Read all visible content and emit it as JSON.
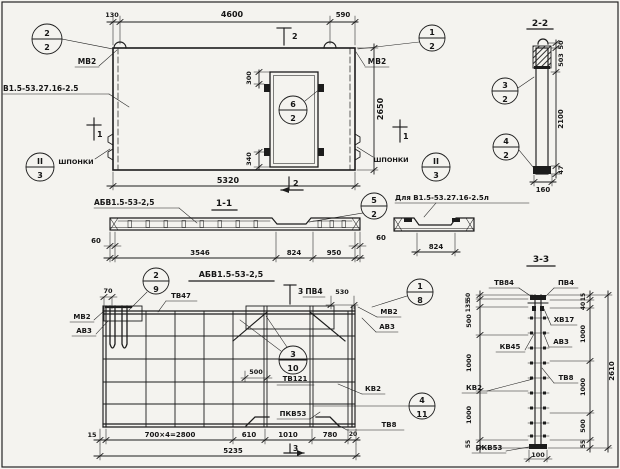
{
  "meta": {
    "paper_color": "#f4f3ef",
    "ink_color": "#1c1c1c",
    "drawing_type": "precast wall panel working drawing"
  },
  "plan": {
    "series_label": "В1.5-53.27.16-2.5",
    "mark_top_left": "МВ2",
    "mark_top_right": "МВ2",
    "keys_left": "ШПОНКИ",
    "keys_right": "ШПОНКИ",
    "dims": {
      "d130": "130",
      "d4600": "4600",
      "d590": "590",
      "d2650": "2650",
      "d5320": "5320",
      "d300": "300",
      "d340": "340"
    },
    "sections": {
      "s1": "1",
      "s2": "2"
    },
    "callouts": {
      "c22": {
        "num": "2",
        "den": "2"
      },
      "c12": {
        "num": "1",
        "den": "2"
      },
      "c62": {
        "num": "6",
        "den": "2"
      },
      "cII3_left": {
        "num": "II",
        "den": "3"
      },
      "cII3_right": {
        "num": "II",
        "den": "3"
      }
    }
  },
  "section22": {
    "title": "2-2",
    "dims": {
      "d50": "50",
      "d503": "503",
      "d2100": "2100",
      "d47": "47",
      "d160": "160"
    },
    "callouts": {
      "c32": {
        "num": "3",
        "den": "2"
      },
      "c42": {
        "num": "4",
        "den": "2"
      }
    }
  },
  "section11": {
    "title": "1-1",
    "label": "АБВ1.5-53-2,5",
    "dims": {
      "d60l": "60",
      "d3546": "3546",
      "d824": "824",
      "d950": "950",
      "d60r": "60"
    },
    "callouts": {
      "c52": {
        "num": "5",
        "den": "2"
      }
    }
  },
  "detail": {
    "label": "Для В1.5-53.27.16-2.5л",
    "dims": {
      "d824": "824"
    }
  },
  "rebar_plan": {
    "title": "АБВ1.5-53-2,5",
    "labels": {
      "tv47": "ТВ47",
      "mb2_left": "МВ2",
      "av3_left": "АВ3",
      "pv4": "ПВ4",
      "mb2_right": "МВ2",
      "av3_right": "АВ3",
      "tv121": "ТВ121",
      "kv2": "КВ2",
      "pkv53": "ПКВ53",
      "tv8": "ТВ8"
    },
    "dims": {
      "d70": "70",
      "d530": "530",
      "d500": "500",
      "d15": "15",
      "d2800": "700×4=2800",
      "d610": "610",
      "d1010": "1010",
      "d780": "780",
      "d20": "20",
      "d5235": "5235"
    },
    "sections": {
      "s3": "3"
    },
    "callouts": {
      "c29": {
        "num": "2",
        "den": "9"
      },
      "c18": {
        "num": "1",
        "den": "8"
      },
      "c310": {
        "num": "3",
        "den": "10"
      },
      "c411": {
        "num": "4",
        "den": "11"
      }
    }
  },
  "section33": {
    "title": "3-3",
    "labels": {
      "tv84": "ТВ84",
      "pv4": "ПВ4",
      "xv17": "ХВ17",
      "av3": "АВ3",
      "kv45": "КВ45",
      "tv8": "ТВ8",
      "kv2": "КВ2",
      "pkv53": "ПКВ53"
    },
    "dims_left": {
      "d50": "50",
      "d135": "135",
      "d500": "500",
      "d1000a": "1000",
      "d1000b": "1000",
      "d55": "55"
    },
    "dims_right": {
      "d15": "15",
      "d40": "40",
      "d1000a": "1000",
      "d1000b": "1000",
      "d500": "500",
      "d55": "55",
      "d2610": "2610",
      "d100": "100"
    }
  }
}
